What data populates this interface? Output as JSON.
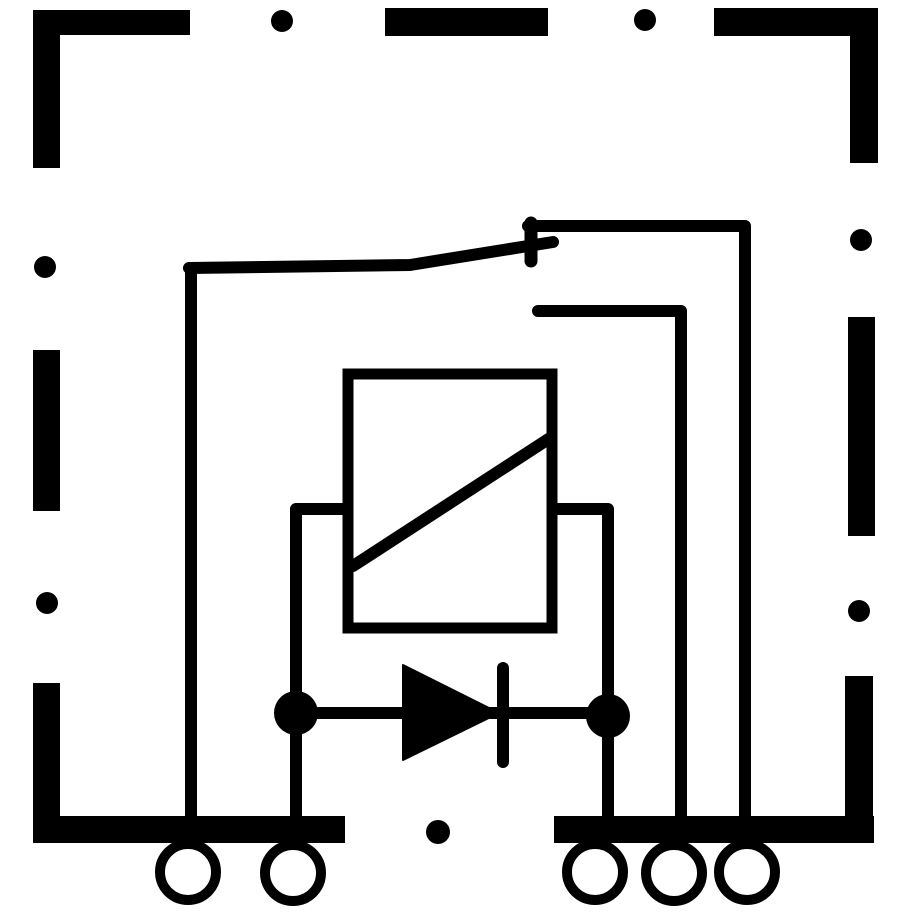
{
  "diagram": {
    "kind": "relay-circuit-schematic",
    "canvas": {
      "width": 913,
      "height": 913
    },
    "colors": {
      "background": "#ffffff",
      "ink": "#000000"
    },
    "wire_width": 12,
    "border_bars": [
      {
        "name": "housing-border-top-left-horizontal",
        "x": 33,
        "y": 10,
        "w": 157,
        "h": 25
      },
      {
        "name": "housing-border-top-left-vertical",
        "x": 33,
        "y": 10,
        "w": 27,
        "h": 158
      },
      {
        "name": "housing-border-top-dash",
        "x": 385,
        "y": 8,
        "w": 163,
        "h": 28
      },
      {
        "name": "housing-border-top-right-horizontal",
        "x": 714,
        "y": 8,
        "w": 164,
        "h": 28
      },
      {
        "name": "housing-border-top-right-vertical",
        "x": 850,
        "y": 8,
        "w": 28,
        "h": 155
      },
      {
        "name": "housing-border-left-dash",
        "x": 33,
        "y": 350,
        "w": 27,
        "h": 161
      },
      {
        "name": "housing-border-bottom-left-vertical",
        "x": 33,
        "y": 683,
        "w": 27,
        "h": 160
      },
      {
        "name": "housing-border-bottom-left-bar",
        "x": 33,
        "y": 816,
        "w": 312,
        "h": 27
      },
      {
        "name": "housing-border-right-dash",
        "x": 848,
        "y": 317,
        "w": 27,
        "h": 219
      },
      {
        "name": "housing-border-bottom-right-vertical",
        "x": 845,
        "y": 676,
        "w": 28,
        "h": 167
      },
      {
        "name": "housing-border-bottom-right-bar",
        "x": 554,
        "y": 816,
        "w": 320,
        "h": 27
      }
    ],
    "border_dots": [
      {
        "name": "housing-border-dot-top-left",
        "cx": 282,
        "cy": 21,
        "r": 11
      },
      {
        "name": "housing-border-dot-top-right",
        "cx": 645,
        "cy": 20,
        "r": 11
      },
      {
        "name": "housing-border-dot-left-upper",
        "cx": 45,
        "cy": 267,
        "r": 11
      },
      {
        "name": "housing-border-dot-left-lower",
        "cx": 47,
        "cy": 603,
        "r": 11
      },
      {
        "name": "housing-border-dot-right-upper",
        "cx": 861,
        "cy": 240,
        "r": 11
      },
      {
        "name": "housing-border-dot-right-lower",
        "cx": 859,
        "cy": 611,
        "r": 11
      },
      {
        "name": "housing-border-dot-bottom",
        "cx": 438,
        "cy": 832,
        "r": 12
      }
    ],
    "wires": [
      {
        "name": "wire-common-terminal-riser",
        "d": "M191 816 L191 268"
      },
      {
        "name": "wire-switch-armature",
        "d": "M189 268 L410 265 L553 242"
      },
      {
        "name": "wire-contact-pivot-stem",
        "d": "M531 223 L531 261",
        "w": 13
      },
      {
        "name": "wire-upper-contact-to-terminal",
        "d": "M528 226 L745 226 L745 816"
      },
      {
        "name": "wire-lower-contact-to-terminal",
        "d": "M538 311 L681 311 L681 816"
      },
      {
        "name": "wire-coil-left-leg",
        "d": "M342 509 L296 509 L296 816"
      },
      {
        "name": "wire-coil-right-leg",
        "d": "M557 509 L608 509 L608 816"
      },
      {
        "name": "wire-diode-link",
        "d": "M296 713 L608 713"
      }
    ],
    "coil": {
      "name": "relay-coil-symbol",
      "box": {
        "x": 348,
        "y": 374,
        "w": 204,
        "h": 254,
        "stroke": 11
      },
      "diagonal": {
        "x1": 353,
        "y1": 566,
        "x2": 550,
        "y2": 438,
        "w": 12
      }
    },
    "diode": {
      "name": "suppression-diode-symbol",
      "triangle_points": "403,665 403,760 499,713",
      "cathode_bar": {
        "x1": 503,
        "y1": 668,
        "x2": 503,
        "y2": 762,
        "w": 12
      }
    },
    "junction_dots": [
      {
        "name": "junction-dot-coil-left",
        "cx": 296,
        "cy": 713,
        "r": 22
      },
      {
        "name": "junction-dot-coil-right",
        "cx": 608,
        "cy": 716,
        "r": 22
      }
    ],
    "terminal_ring": {
      "radius": 28,
      "stroke": 10
    },
    "terminals": [
      {
        "name": "terminal-pin-1",
        "cx": 188,
        "cy": 872
      },
      {
        "name": "terminal-pin-2",
        "cx": 293,
        "cy": 873
      },
      {
        "name": "terminal-pin-3",
        "cx": 595,
        "cy": 872
      },
      {
        "name": "terminal-pin-4",
        "cx": 674,
        "cy": 873
      },
      {
        "name": "terminal-pin-5",
        "cx": 747,
        "cy": 872
      }
    ]
  }
}
